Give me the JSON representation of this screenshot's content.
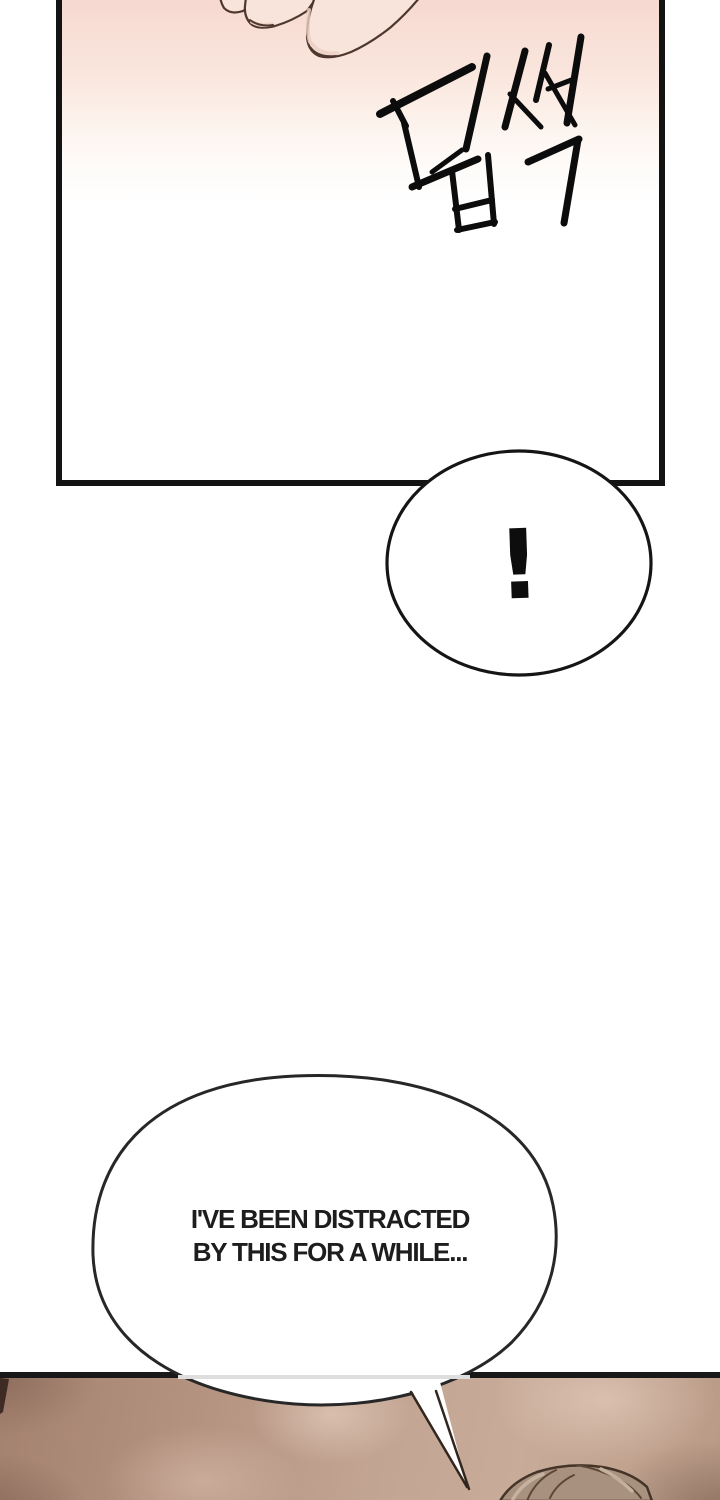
{
  "comic": {
    "top_panel": {
      "sfx_korean": "덥썩",
      "description": "fingers-grabbing-panel"
    },
    "exclamation_bubble": {
      "text": "!"
    },
    "speech_bubble": {
      "line1": "I'VE BEEN DISTRACTED",
      "line2": "BY THIS FOR A WHILE..."
    }
  },
  "colors": {
    "page_bg": "#ffffff",
    "panel_border": "#131313",
    "blush_top": "#f6d8d0",
    "skin_fill": "#f8e4db",
    "skin_outline": "#4e372e",
    "ink": "#0c0c0c",
    "bottom_panel_base": "#b99a87",
    "hair_fill": "#a99180",
    "speech_text": "#1d1d1d"
  }
}
